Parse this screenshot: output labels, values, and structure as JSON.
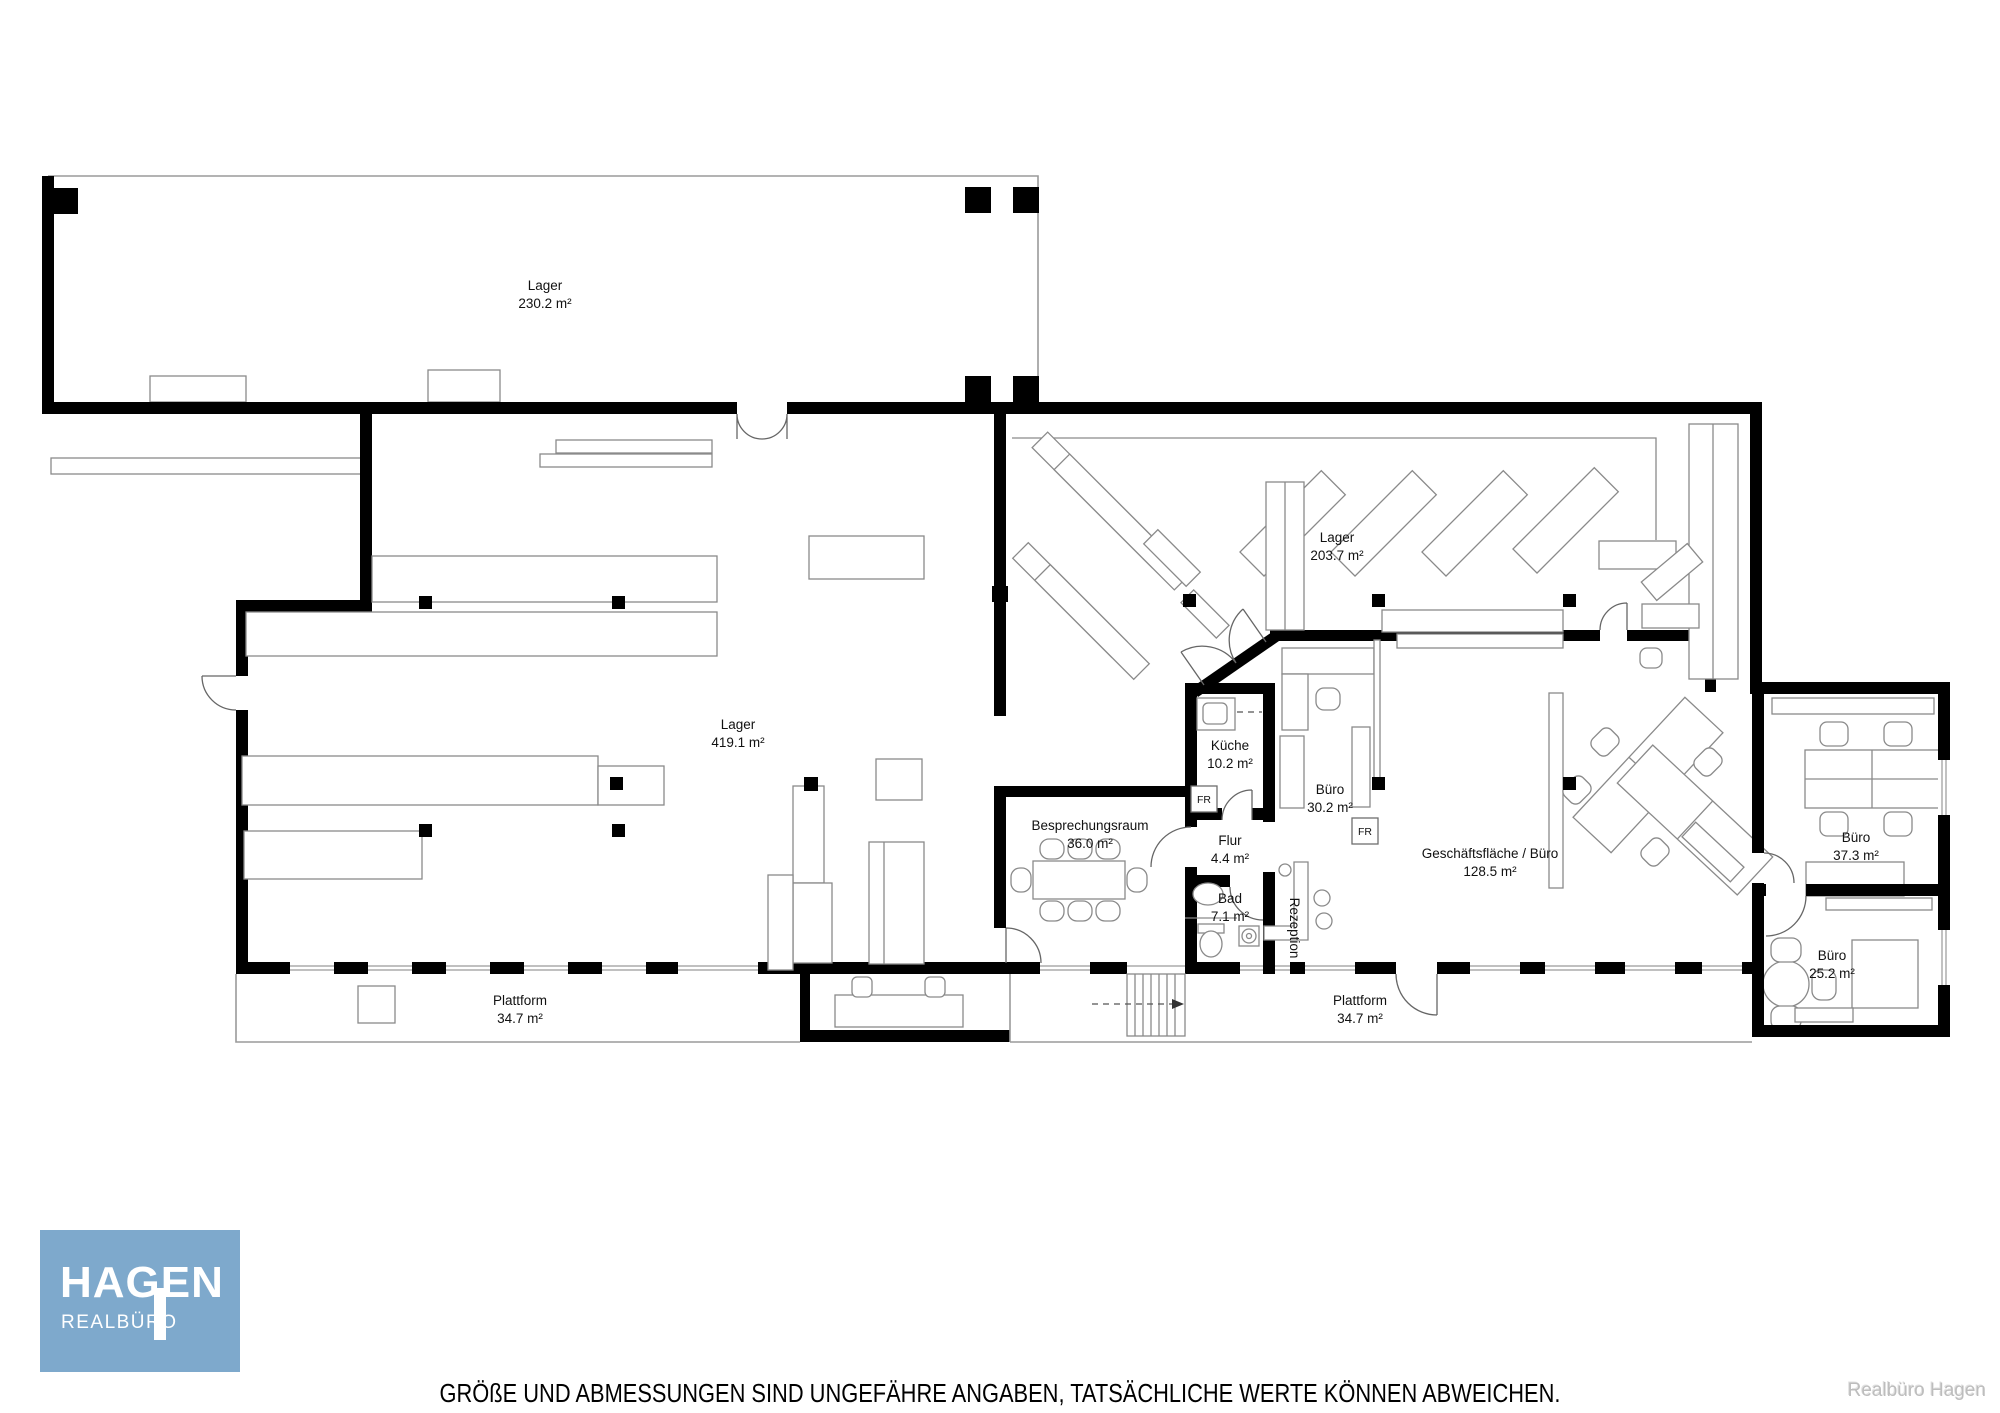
{
  "plan": {
    "rooms": {
      "lager_links": {
        "name": "Lager",
        "area": "230.2 m²"
      },
      "lager_mitte": {
        "name": "Lager",
        "area": "419.1 m²"
      },
      "lager_rechts": {
        "name": "Lager",
        "area": "203.7 m²"
      },
      "besprechungsraum": {
        "name": "Besprechungsraum",
        "area": "36.0 m²"
      },
      "kueche": {
        "name": "Küche",
        "area": "10.2 m²"
      },
      "buero_mitte": {
        "name": "Büro",
        "area": "30.2 m²"
      },
      "flur": {
        "name": "Flur",
        "area": "4.4 m²"
      },
      "bad": {
        "name": "Bad",
        "area": "7.1 m²"
      },
      "rezeption": {
        "name": "Rezeption"
      },
      "geschaeftsflaeche": {
        "name": "Geschäftsfläche / Büro",
        "area": "128.5 m²"
      },
      "buero_rechts_oben": {
        "name": "Büro",
        "area": "37.3 m²"
      },
      "buero_rechts_unten": {
        "name": "Büro",
        "area": "25.2 m²"
      },
      "plattform_links": {
        "name": "Plattform",
        "area": "34.7 m²"
      },
      "plattform_rechts": {
        "name": "Plattform",
        "area": "34.7 m²"
      }
    },
    "markers": {
      "fr_kueche": "FR",
      "fr_buero": "FR"
    }
  },
  "logo": {
    "line1": "HAGEN",
    "line2": "REALBÜRO",
    "bg_color": "#7ea9cc",
    "text_color": "#ffffff"
  },
  "footer": {
    "disclaimer": "GRÖßE UND ABMESSUNGEN SIND UNGEFÄHRE ANGABEN, TATSÄCHLICHE WERTE KÖNNEN ABWEICHEN.",
    "watermark": "Realbüro Hagen"
  }
}
